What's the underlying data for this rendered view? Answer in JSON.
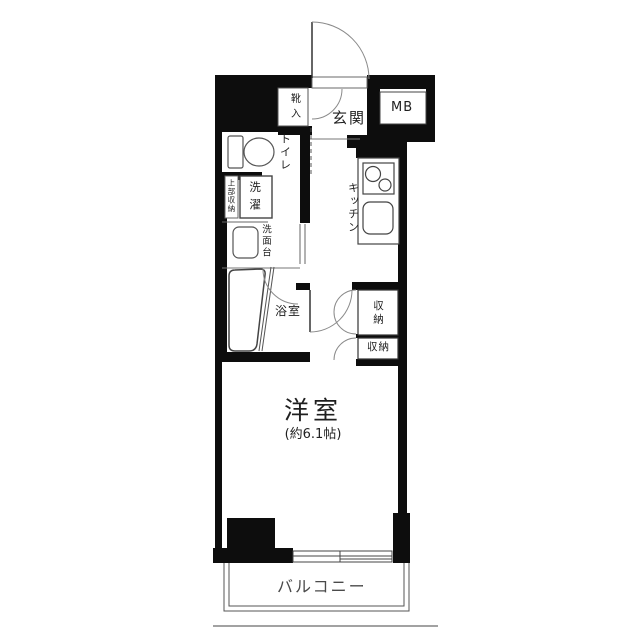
{
  "colors": {
    "wall": "#0d0d0d",
    "fixture_line": "#555555",
    "door_arc": "#8a8a8a",
    "text": "#1f1f1f",
    "balcony_text": "#4a4a4a",
    "background": "#ffffff"
  },
  "labels": {
    "entrance": "玄関",
    "meter_box": "MB",
    "shoe_cabinet": "靴入",
    "toilet": "トイレ",
    "upper_shelf": "上部収納",
    "laundry": "洗濯",
    "washstand": "洗面台",
    "bathroom": "浴室",
    "kitchen": "キッチン",
    "storage_upper": "収納",
    "storage_lower": "収納",
    "western_room": "洋室",
    "western_room_size": "(約6.1帖)",
    "balcony": "バルコニー"
  }
}
